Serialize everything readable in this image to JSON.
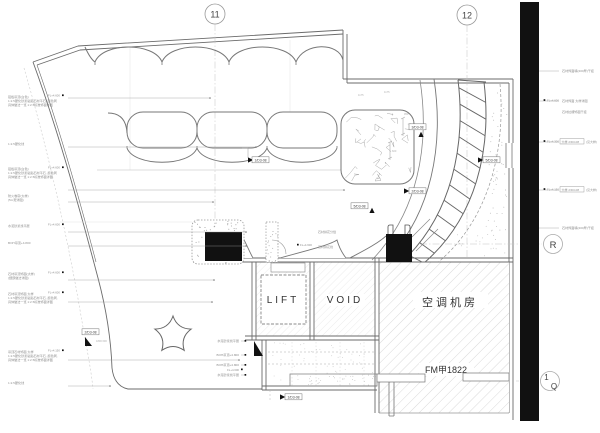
{
  "colors": {
    "main_line": "#6b6b6b",
    "mid_line": "#999999",
    "faint_line": "#cccccc",
    "black": "#111111",
    "hatch": "#c9c9c9",
    "hatch_light": "#dedede",
    "bg": "#ffffff"
  },
  "grid": {
    "b11": {
      "label": "11"
    },
    "b12": {
      "label": "12"
    },
    "bR": {
      "label": "R"
    },
    "b1Q": {
      "label": "1",
      "sub": "Q"
    }
  },
  "rooms": {
    "lift": {
      "label": "LIFT"
    },
    "void": {
      "label": "VOID"
    },
    "ac": {
      "label": "空调机房"
    },
    "door": {
      "label": "FM甲1822"
    }
  },
  "section_markers": [
    {
      "label": "1/D3-08",
      "lx": 253,
      "ly": 160,
      "tx": 248,
      "ty": 160,
      "dir": "right"
    },
    {
      "label": "3/D3-08",
      "lx": 410,
      "ly": 127,
      "tx": 421,
      "ty": 137,
      "dir": "up"
    },
    {
      "label": "5/D3-08",
      "lx": 484,
      "ly": 160,
      "tx": 478,
      "ty": 160,
      "dir": "right"
    },
    {
      "label": "2/D3-08",
      "lx": 410,
      "ly": 191,
      "tx": 404,
      "ty": 191,
      "dir": "right"
    },
    {
      "label": "5/D3-08",
      "lx": 352,
      "ly": 206,
      "tx": 372,
      "ty": 213,
      "dir": "up"
    },
    {
      "label": "1/D3-08",
      "lx": 286,
      "ly": 397,
      "tx": 280,
      "ty": 397,
      "dir": "right"
    },
    {
      "label": "2/D3-08",
      "lx": 83,
      "ly": 332,
      "tx": 85,
      "ty": 346,
      "dir": "corner"
    }
  ],
  "left_annotations": [
    {
      "y": 98,
      "fl": "FL+4.600",
      "lines": [
        "铝板吊顶(白色)",
        "1:2.5硬化砂浆粘贴石材平石, 颜色同",
        "具体做法一览 1:2.5标准饰面详图"
      ],
      "ly": 98,
      "lto": 210
    },
    {
      "y": 145,
      "lines": [
        "1:2.5硬化线"
      ],
      "ly": 147,
      "lto": 256
    },
    {
      "y": 170,
      "fl": "FL+4.600",
      "lines": [
        "铝板吊顶(白色)",
        "1:2.5硬化砂浆粘贴石材平石, 颜色同",
        "具体做法一览 1:2.5标准饰面详图"
      ],
      "ly": 190,
      "lto": 344
    },
    {
      "y": 197,
      "lines": [
        "防火卷帘(大样)",
        "(5m宽详图)"
      ],
      "ly": 202,
      "lto": 213
    },
    {
      "y": 227,
      "fl": "FL+4.600",
      "lines": [
        "水泥砂浆找平层"
      ],
      "ly": 232,
      "lto": 246
    },
    {
      "y": 244,
      "lines": [
        "BOH吊顶+4.800"
      ],
      "ly": 246,
      "lto": 246
    },
    {
      "y": 275,
      "fl": "FL+4.600",
      "lines": [
        "石材吊顶饰面(大样)",
        "(细部做法详图)"
      ],
      "ly": 280,
      "lto": 214
    },
    {
      "y": 295,
      "fl": "FL+4.600",
      "lines": [
        "石材吊顶饰面 大样",
        "1:2.5硬化砂浆粘贴石材平石, 颜色同,",
        "具体做法一览 1:2.5标准饰面详图"
      ],
      "ly": 302,
      "lto": 212
    },
    {
      "y": 353,
      "fl": "FL+4.150",
      "lines": [
        "吊顶石材饰面 大样",
        "1:2.5硬化砂浆粘贴石材平石, 颜色同,",
        "具体做法一览 1:2.5标准饰面详图"
      ],
      "ly": 360,
      "lto": 239
    },
    {
      "y": 384,
      "lines": [
        "1:2.5硬化线"
      ],
      "ly": 386,
      "lto": 110
    }
  ],
  "mid_annotations": [
    {
      "y": 342,
      "text": "水泥砂浆找平层"
    },
    {
      "y": 356,
      "text": "BOH吊顶+4.800"
    },
    {
      "y": 366,
      "text": "BOH吊顶+4.800"
    },
    {
      "y": 376,
      "fl": "FL+4.600",
      "text": "水泥砂浆找平层"
    }
  ],
  "col_annotations": [
    {
      "x": 318,
      "y": 233,
      "text": "石材拼花分缝"
    },
    {
      "x": 318,
      "y": 248,
      "text": "石材拼花线",
      "fl": "FL+4.600",
      "flx": 300,
      "fly": 246
    }
  ],
  "right_annotations": [
    {
      "y": 71,
      "lines": [
        "石材饰面墙(200厚)干挂"
      ]
    },
    {
      "y": 101,
      "lines": [
        "石材饰面 大样详图",
        "石材拉槽饰面干挂"
      ],
      "fl": "FL+4.600",
      "fly": 110
    },
    {
      "y": 142,
      "fl": "FL+4.300",
      "box": "大样 2/D3-08",
      "suffix": "(见大样)"
    },
    {
      "y": 190,
      "fl": "FL+4.150",
      "box": "大样 2/D3-08",
      "suffix": "(见大样)"
    },
    {
      "y": 228,
      "lines": [
        "石材饰面墙(200厚)干挂"
      ]
    }
  ],
  "tiny_texts": [
    {
      "x": 358,
      "y": 96,
      "t": "1175"
    },
    {
      "x": 384,
      "y": 93,
      "t": "1175"
    },
    {
      "x": 404,
      "y": 115,
      "t": "950"
    },
    {
      "x": 96,
      "y": 342,
      "t": "1800 600"
    },
    {
      "x": 392,
      "y": 152,
      "t": "600"
    }
  ]
}
